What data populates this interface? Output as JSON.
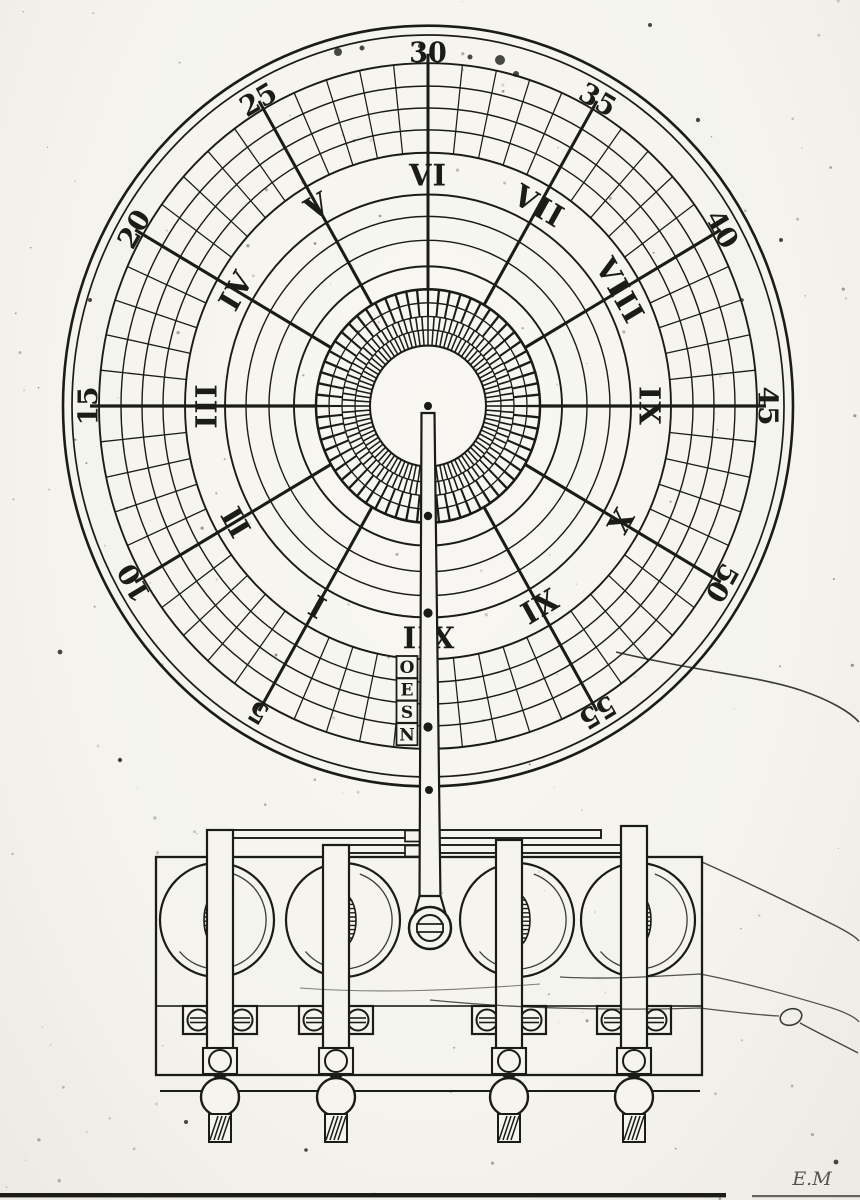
{
  "meta": {
    "description": "Engraved plate of a clock dial with minute ring, hour ring, compass-lettered pointer rod, and a wheeled base mechanism",
    "figure_type": "engraving-scan"
  },
  "palette": {
    "paper": "#f5f4ee",
    "ink": "#1b1b18",
    "faint_ink": "#3a3a36"
  },
  "dial": {
    "minute_labels": [
      "0",
      "5",
      "10",
      "15",
      "20",
      "25",
      "30",
      "35",
      "40",
      "45",
      "50",
      "55"
    ],
    "hour_labels": [
      "XII",
      "I",
      "II",
      "III",
      "IV",
      "V",
      "VI",
      "VII",
      "VIII",
      "IX",
      "X",
      "XI"
    ],
    "rod_letters": [
      "O",
      "E",
      "S",
      "N"
    ]
  },
  "signature": "E.M"
}
